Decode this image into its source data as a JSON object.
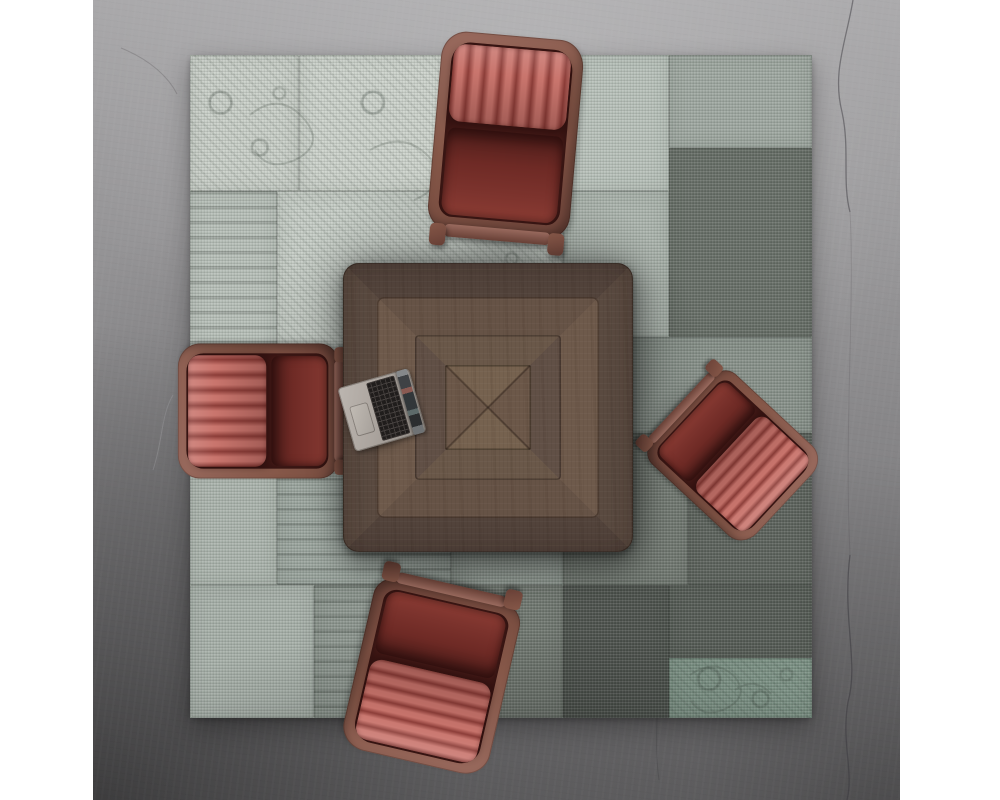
{
  "scene": {
    "description": "Top-down render of a square walnut conference table with an open laptop and four dark-red leather channel-tufted armchairs on a distressed gray patchwork rug over a concrete floor",
    "photo": {
      "left": 93,
      "top": 0,
      "width": 807,
      "height": 800,
      "margin_color": "#ffffff"
    },
    "palette": {
      "floor_base": "#8e8d8f",
      "floor_light": "#a7a6a8",
      "floor_dark": "#565458",
      "crack": "#47454a",
      "rug_base": "#bcc3bd",
      "chair_wood_light": "#996a5e",
      "chair_wood": "#855748",
      "chair_wood_dark": "#6b4238",
      "chair_seat": "#6e2a25",
      "rib_base": "#b05a54",
      "rib_light": "#c9756d",
      "rib_dark": "#8c3d38",
      "table_outer_a": "#5a4a40",
      "table_outer_b": "#52433b",
      "table_ring2_a": "#6e5a4b",
      "table_ring2_b": "#665346",
      "table_ring3_a": "#615046",
      "table_ring3_b": "#6a5849",
      "table_center_a": "#6c5849",
      "table_center_b": "#76624f",
      "laptop_body": "#aba49e",
      "laptop_keys": "#201d1c"
    },
    "rug": {
      "left": 97,
      "top": 55,
      "width": 622,
      "height": 663,
      "patches": [
        {
          "x": 0,
          "y": 0,
          "w": 17.5,
          "h": 20.5,
          "color": "#c8cec7",
          "style": "ornate"
        },
        {
          "x": 17.5,
          "y": 0,
          "w": 42.5,
          "h": 20.5,
          "color": "#cbd1ca",
          "style": "ornate"
        },
        {
          "x": 60,
          "y": 0,
          "w": 17,
          "h": 20.5,
          "color": "#b6bfb8",
          "style": "plain"
        },
        {
          "x": 77,
          "y": 0,
          "w": 23,
          "h": 14,
          "color": "#9da69f",
          "style": "plain"
        },
        {
          "x": 77,
          "y": 14,
          "w": 23,
          "h": 28.5,
          "color": "#666d66",
          "style": "plain"
        },
        {
          "x": 0,
          "y": 20.5,
          "w": 14,
          "h": 36.5,
          "color": "#b5bdb6",
          "style": "bands"
        },
        {
          "x": 14,
          "y": 20.5,
          "w": 46,
          "h": 36.5,
          "color": "#c4cbc4",
          "style": "ornate"
        },
        {
          "x": 60,
          "y": 20.5,
          "w": 17,
          "h": 22,
          "color": "#a9b2ab",
          "style": "plain"
        },
        {
          "x": 60,
          "y": 42.5,
          "w": 40,
          "h": 14.5,
          "color": "#868f88",
          "style": "plain"
        },
        {
          "x": 0,
          "y": 57,
          "w": 14,
          "h": 23,
          "color": "#a9b2ab",
          "style": "plain"
        },
        {
          "x": 14,
          "y": 57,
          "w": 28,
          "h": 23,
          "color": "#99a39c",
          "style": "bands"
        },
        {
          "x": 42,
          "y": 57,
          "w": 18,
          "h": 23,
          "color": "#8d968f",
          "style": "plain"
        },
        {
          "x": 60,
          "y": 57,
          "w": 20,
          "h": 23,
          "color": "#6f766f",
          "style": "plain"
        },
        {
          "x": 80,
          "y": 57,
          "w": 20,
          "h": 23,
          "color": "#5b615b",
          "style": "plain"
        },
        {
          "x": 0,
          "y": 80,
          "w": 20,
          "h": 20,
          "color": "#a5aea7",
          "style": "plain"
        },
        {
          "x": 20,
          "y": 80,
          "w": 22,
          "h": 20,
          "color": "#8a938c",
          "style": "bands"
        },
        {
          "x": 42,
          "y": 80,
          "w": 18,
          "h": 20,
          "color": "#6e756e",
          "style": "plain"
        },
        {
          "x": 60,
          "y": 80,
          "w": 17,
          "h": 20,
          "color": "#4c514c",
          "style": "plain"
        },
        {
          "x": 77,
          "y": 80,
          "w": 23,
          "h": 11,
          "color": "#545a54",
          "style": "plain"
        },
        {
          "x": 77,
          "y": 91,
          "w": 23,
          "h": 9,
          "color": "#7d9386",
          "style": "ornate"
        }
      ]
    },
    "table": {
      "left": 250,
      "top": 263,
      "width": 290,
      "height": 289
    },
    "laptop": {
      "cx": 289,
      "cy": 410,
      "width": 74,
      "height": 66,
      "rotation": -16
    },
    "chairs": {
      "count": 4,
      "items": [
        {
          "id": "chair-top",
          "cx": 412,
          "cy": 143,
          "rotation": 5,
          "sx": 0.95,
          "sy": 1.05,
          "back_depth": 74,
          "rib_axis": "cols"
        },
        {
          "id": "chair-left",
          "cx": 172,
          "cy": 411,
          "rotation": -90,
          "sx": 0.9,
          "sy": 0.85,
          "back_depth": 92,
          "rib_axis": "cols"
        },
        {
          "id": "chair-right",
          "cx": 636,
          "cy": 452,
          "rotation": 133,
          "sx": 0.82,
          "sy": 0.74,
          "back_depth": 95,
          "rib_axis": "rows"
        },
        {
          "id": "chair-bottom",
          "cx": 340,
          "cy": 669,
          "rotation": 193,
          "sx": 1.0,
          "sy": 0.93,
          "back_depth": 88,
          "rib_axis": "rows"
        }
      ]
    }
  }
}
